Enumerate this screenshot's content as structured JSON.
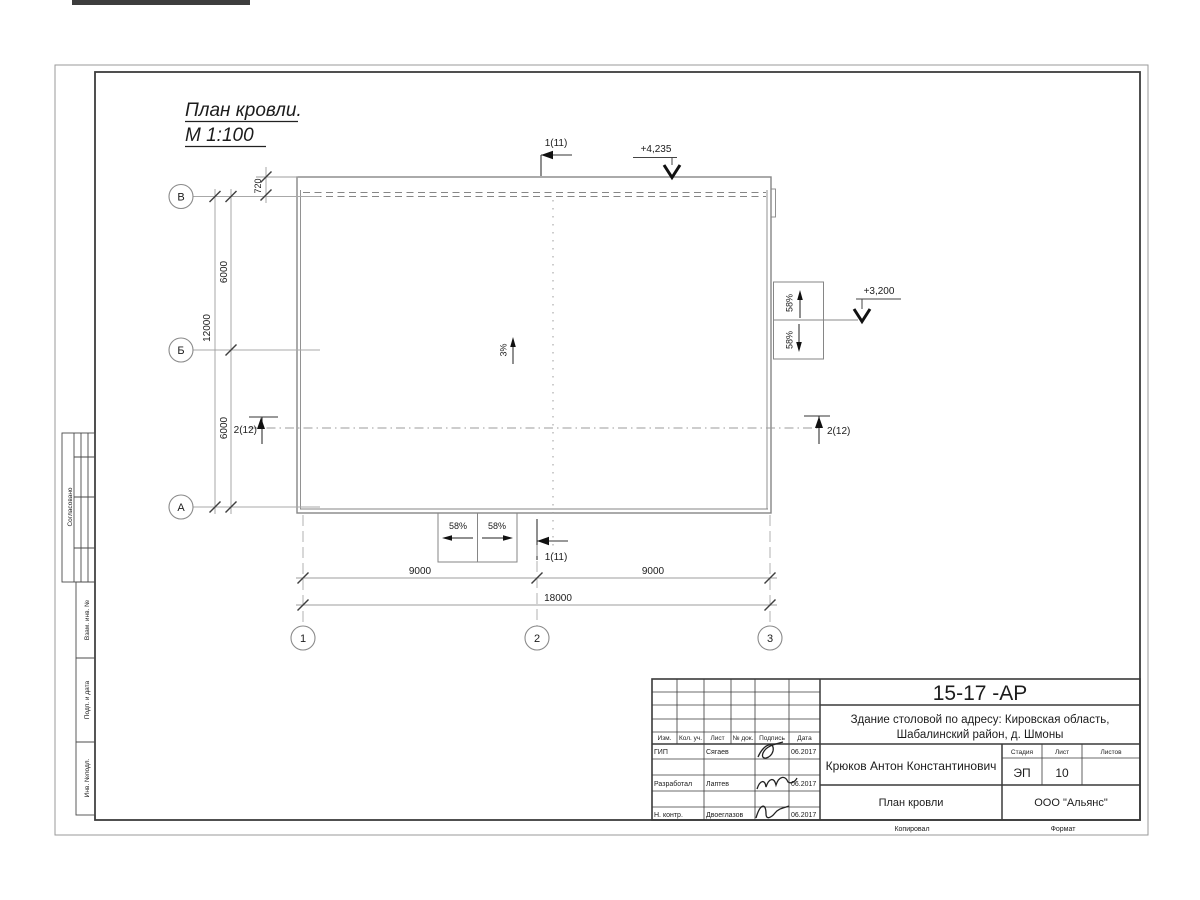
{
  "page": {
    "title_line1": "План кровли.",
    "title_line2": "М 1:100"
  },
  "axes": {
    "row_top": "В",
    "row_mid": "Б",
    "row_bottom": "А",
    "col_left": "1",
    "col_mid": "2",
    "col_right": "3"
  },
  "dims": {
    "parapet": "720",
    "left_upper": "6000",
    "left_lower": "6000",
    "left_total": "12000",
    "bottom_left": "9000",
    "bottom_right": "9000",
    "bottom_total": "18000"
  },
  "marks": {
    "section_1": "1(11)",
    "section_2": "2(12)",
    "elev_top": "+4,235",
    "elev_right": "+3,200",
    "slope_main": "3%",
    "slope_58": "58%"
  },
  "margin": {
    "approved": "Согласовано",
    "replace_inv": "Взам. инв. №",
    "sign_date": "Подп. и дата",
    "inv_orig": "Инв. №подл."
  },
  "stamp": {
    "doc": "15-17 -АР",
    "object1": "Здание столовой по адресу: Кировская область,",
    "object2": "Шабалинский район, д. Шмоны",
    "author": "Крюков Антон Константинович",
    "sheet_name": "План кровли",
    "org": "ООО \"Альянс\"",
    "col_izm": "Изм.",
    "col_kol": "Кол. уч.",
    "col_list": "Лист",
    "col_doc": "№ док.",
    "col_sign": "Подпись",
    "col_date": "Дата",
    "stage_h": "Стадия",
    "list_h": "Лист",
    "listov_h": "Листов",
    "stage": "ЭП",
    "list": "10",
    "rows": [
      {
        "role": "ГИП",
        "name": "Сягаев",
        "date": "06.2017"
      },
      {
        "role": "Разработал",
        "name": "Лаптев",
        "date": "06.2017"
      },
      {
        "role": "Н. контр.",
        "name": "Двоеглазов",
        "date": "06.2017"
      }
    ],
    "copied": "Копировал",
    "format": "Формат"
  }
}
